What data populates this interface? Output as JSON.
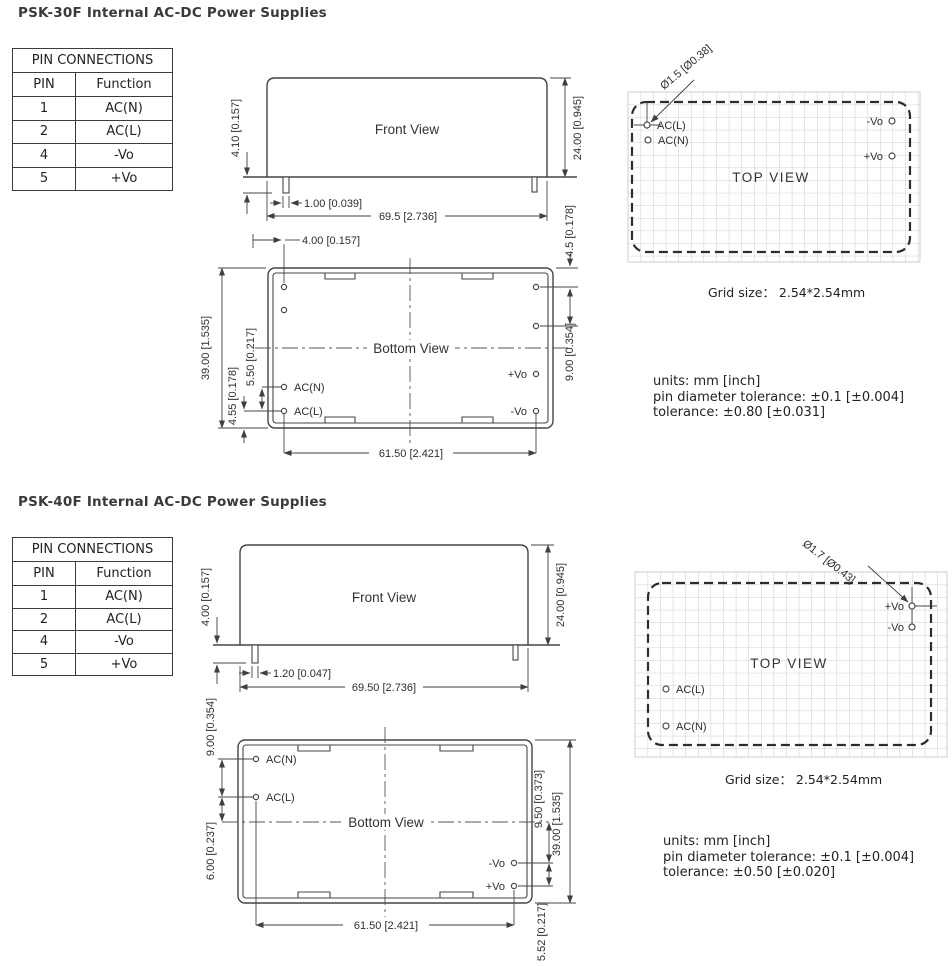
{
  "sections": [
    {
      "title": "PSK-30F Internal AC-DC Power Supplies",
      "pin_table": {
        "title": "PIN CONNECTIONS",
        "col_pin": "PIN",
        "col_function": "Function",
        "rows": [
          {
            "pin": "1",
            "function": "AC(N)"
          },
          {
            "pin": "2",
            "function": "AC(L)"
          },
          {
            "pin": "4",
            "function": "-Vo"
          },
          {
            "pin": "5",
            "function": "+Vo"
          }
        ]
      },
      "front_view": {
        "label": "Front View",
        "dim_pin_length": "4.10 [0.157]",
        "dim_pin_width": "1.00 [0.039]",
        "dim_body_width": "69.5 [2.736]",
        "dim_body_height": "24.00 [0.945]"
      },
      "bottom_view": {
        "label": "Bottom View",
        "dim_pin_col_offset": "4.00 [0.157]",
        "dim_corner_pin": "4.5 [0.178]",
        "dim_right_pin_pitch": "9.00 [0.354]",
        "dim_body_length": "39.00 [1.535]",
        "dim_ac_pitch": "5.50 [0.217]",
        "dim_acl_edge": "4.55 [0.178]",
        "dim_pin_span": "61.50 [2.421]",
        "pins": {
          "acn": "AC(N)",
          "acl": "AC(L)",
          "pvo": "+Vo",
          "nvo": "-Vo"
        }
      },
      "top_view": {
        "label": "TOP VIEW",
        "pin_diameter": "Ø1.5 [Ø0.38]",
        "pins": {
          "acl": "AC(L)",
          "acn": "AC(N)",
          "nvo": "-Vo",
          "pvo": "+Vo"
        },
        "grid_caption": "Grid size： 2.54*2.54mm"
      },
      "notes": [
        "units: mm [inch]",
        "pin diameter tolerance: ±0.1 [±0.004]",
        "tolerance: ±0.80 [±0.031]"
      ]
    },
    {
      "title": "PSK-40F Internal AC-DC Power Supplies",
      "pin_table": {
        "title": "PIN CONNECTIONS",
        "col_pin": "PIN",
        "col_function": "Function",
        "rows": [
          {
            "pin": "1",
            "function": "AC(N)"
          },
          {
            "pin": "2",
            "function": "AC(L)"
          },
          {
            "pin": "4",
            "function": "-Vo"
          },
          {
            "pin": "5",
            "function": "+Vo"
          }
        ]
      },
      "front_view": {
        "label": "Front View",
        "dim_pin_length": "4.00 [0.157]",
        "dim_pin_width": "1.20 [0.047]",
        "dim_body_width": "69.50 [2.736]",
        "dim_body_height": "24.00 [0.945]"
      },
      "bottom_view": {
        "label": "Bottom View",
        "dim_ac_pitch": "9.00 [0.354]",
        "dim_acl_center": "6.00 [0.237]",
        "dim_center_nvo": "9.50 [0.373]",
        "dim_vo_pitch": "5.52 [0.217]",
        "dim_body_length": "39.00 [1.535]",
        "dim_pin_span": "61.50 [2.421]",
        "pins": {
          "acn": "AC(N)",
          "acl": "AC(L)",
          "pvo": "+Vo",
          "nvo": "-Vo"
        }
      },
      "top_view": {
        "label": "TOP VIEW",
        "pin_diameter": "Ø1.7 [Ø0.43]",
        "pins": {
          "acl": "AC(L)",
          "acn": "AC(N)",
          "nvo": "-Vo",
          "pvo": "+Vo"
        },
        "grid_caption": "Grid size： 2.54*2.54mm"
      },
      "notes": [
        "units: mm [inch]",
        "pin diameter tolerance: ±0.1 [±0.004]",
        "tolerance: ±0.50 [±0.020]"
      ]
    }
  ]
}
